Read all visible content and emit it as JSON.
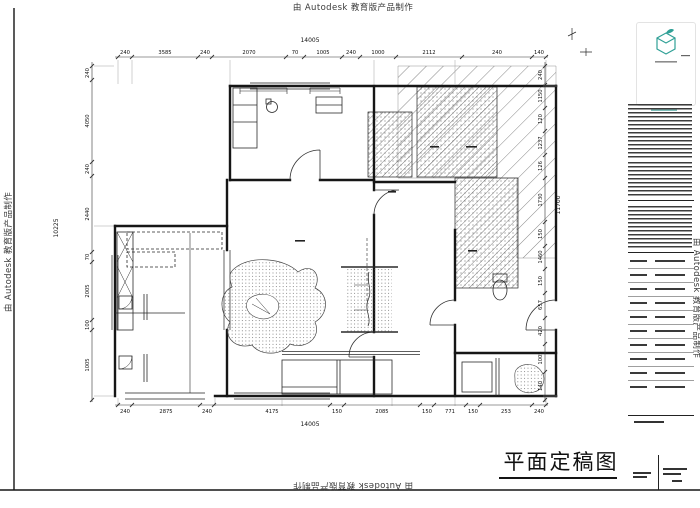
{
  "watermark": {
    "text": "由 Autodesk 教育版产品制作"
  },
  "logo": {
    "company": "固家",
    "char1": "固",
    "char2": "家"
  },
  "title_block": {
    "drawing_title": "平面定稿图"
  },
  "dimensions": {
    "overall_top": "14005",
    "overall_bottom": "14005",
    "overall_left": "10225",
    "overall_right": "11700",
    "top_chain": [
      "240",
      "3585",
      "240",
      "2070",
      "70",
      "1005",
      "240",
      "1000",
      "2112",
      "240",
      "140"
    ],
    "bottom_chain": [
      "240",
      "2875",
      "240",
      "4175",
      "150",
      "2085",
      "150",
      "771",
      "150",
      "253",
      "240"
    ],
    "left_chain": [
      "240",
      "4050",
      "240",
      "2440",
      "70",
      "2005",
      "100",
      "1005"
    ],
    "right_chain": [
      "240",
      "1150",
      "120",
      "1237",
      "126",
      "1730",
      "150",
      "1460",
      "150",
      "657",
      "420",
      "1005",
      "140"
    ]
  },
  "colors": {
    "line": "#1c1c1c",
    "teal": "#2fa096",
    "watermark": "#3a3a3a"
  }
}
